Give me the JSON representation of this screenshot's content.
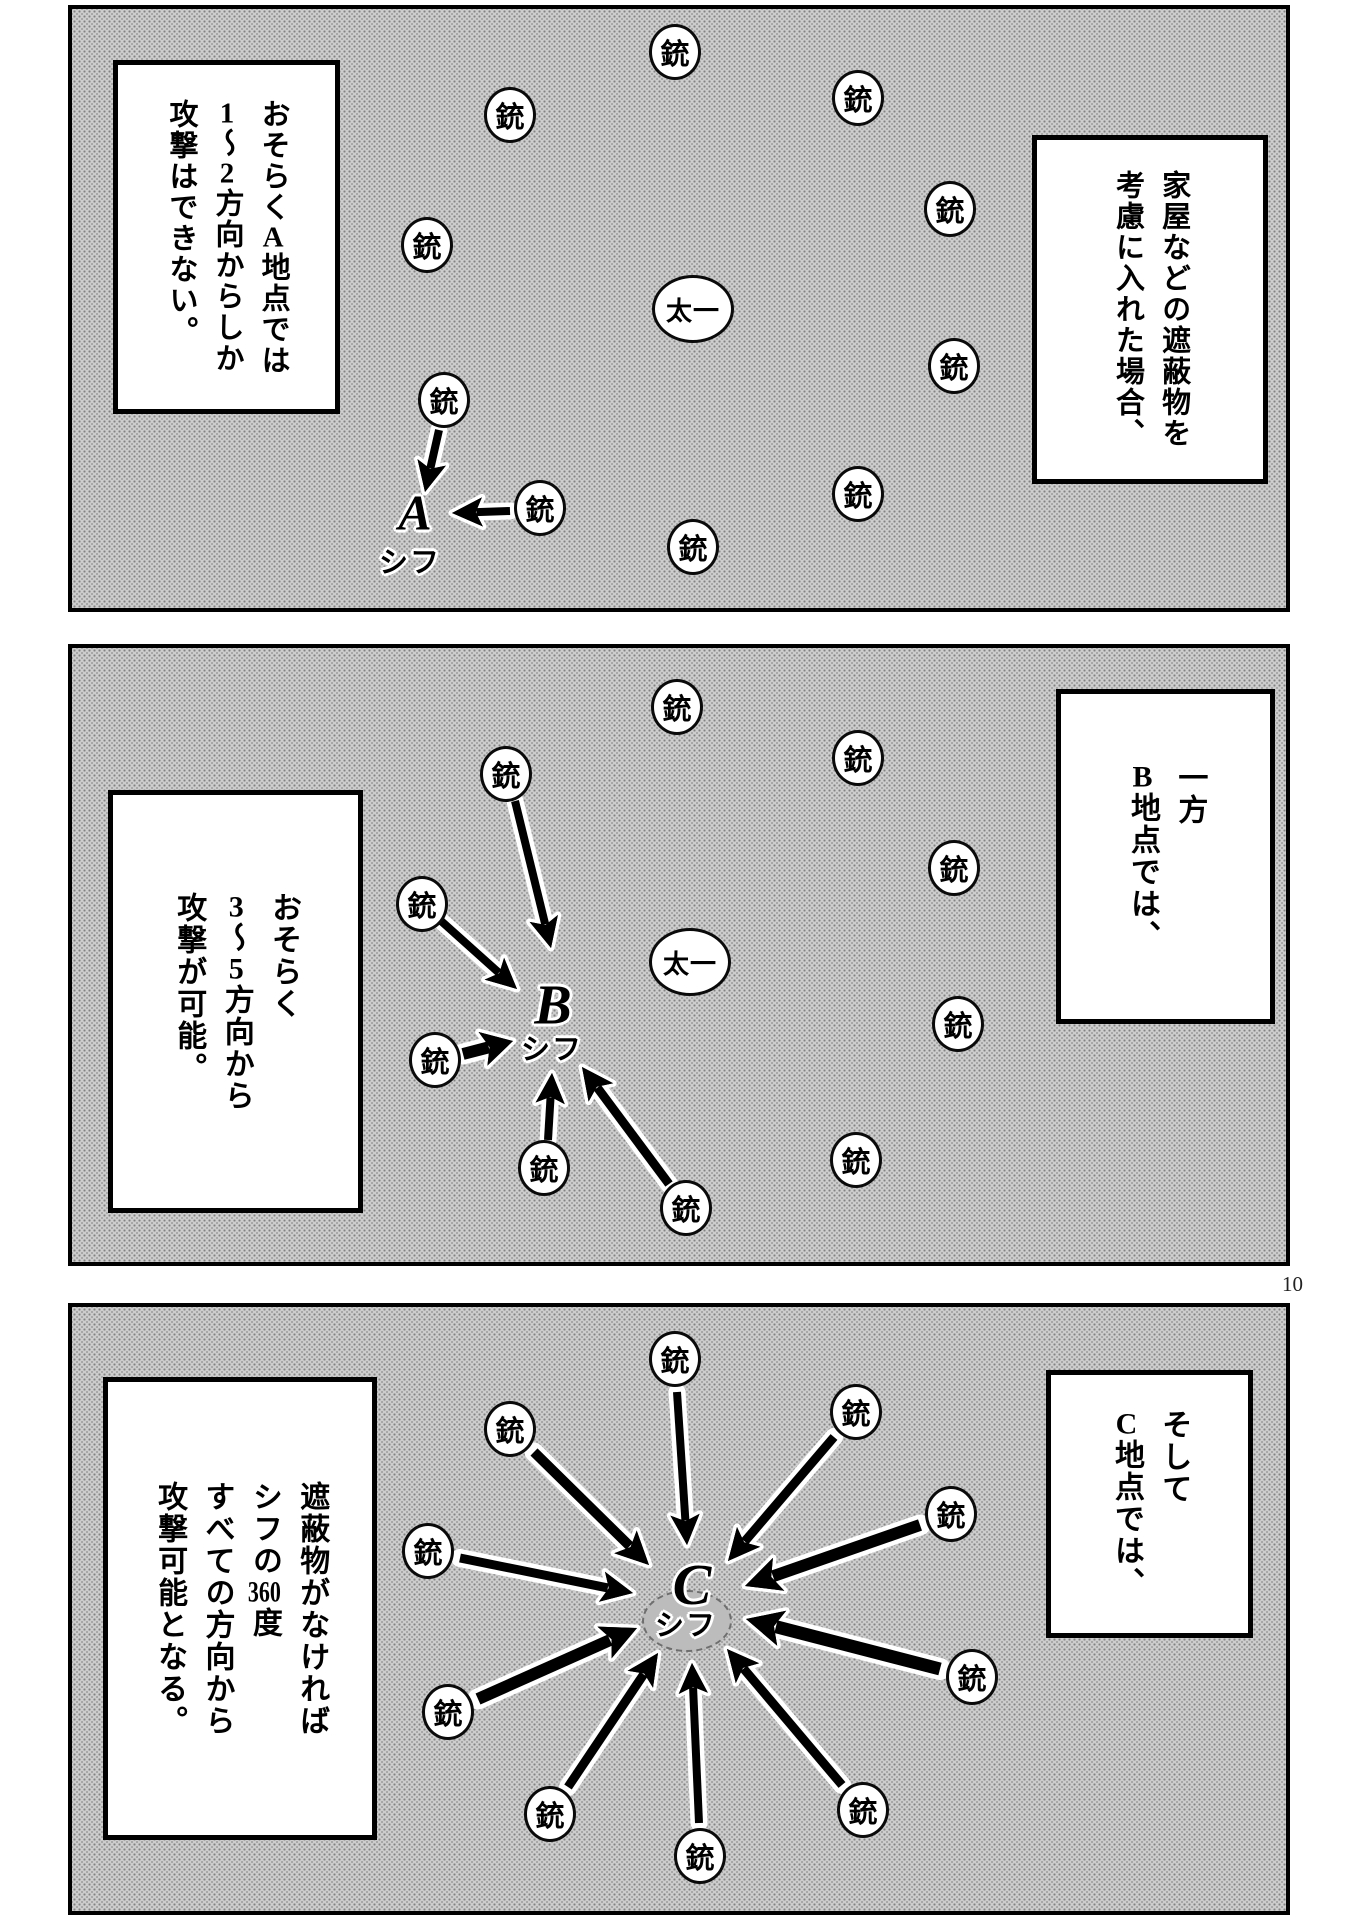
{
  "page": {
    "width": 1359,
    "height": 1920,
    "number": "10",
    "background": "#ffffff"
  },
  "colors": {
    "panel_tone": "#cdcdcd",
    "ink": "#000000",
    "circle_fill": "#ffffff",
    "spot_fill": "#bcbcbc"
  },
  "glyphs": {
    "gun": "銃",
    "taichi": "太一",
    "shifu": "シフ"
  },
  "panels": [
    {
      "id": "a",
      "frame": {
        "x": 68,
        "y": 5,
        "w": 1222,
        "h": 607
      },
      "caption_right": {
        "x": 1032,
        "y": 135,
        "w": 236,
        "h": 349,
        "font": 29,
        "columns": [
          "家屋などの遮蔽物を",
          "考慮に入れた場合、"
        ]
      },
      "caption_left": {
        "x": 113,
        "y": 60,
        "w": 227,
        "h": 354,
        "font": 29,
        "columns": [
          "おそらく[A]地点では",
          "[1]〜[2]方向からしか",
          "攻撃はできない。"
        ]
      },
      "guns": [
        [
          675,
          52
        ],
        [
          510,
          115
        ],
        [
          858,
          98
        ],
        [
          950,
          209
        ],
        [
          427,
          245
        ],
        [
          954,
          366
        ],
        [
          444,
          400
        ],
        [
          858,
          494
        ],
        [
          540,
          508
        ],
        [
          693,
          547
        ]
      ],
      "taichi": [
        693,
        309
      ],
      "point": {
        "letter": "A",
        "x": 415,
        "y": 515,
        "size": 50,
        "sub_x": 410,
        "sub_y": 560
      },
      "arrows": [
        [
          439,
          430,
          425,
          492,
          8
        ],
        [
          510,
          511,
          452,
          513,
          8
        ]
      ]
    },
    {
      "id": "b",
      "frame": {
        "x": 68,
        "y": 644,
        "w": 1222,
        "h": 622
      },
      "caption_right": {
        "x": 1056,
        "y": 689,
        "w": 219,
        "h": 335,
        "font": 30,
        "columns": [
          "一方",
          "[B]地点では、"
        ]
      },
      "caption_left": {
        "x": 108,
        "y": 790,
        "w": 255,
        "h": 423,
        "font": 30,
        "columns": [
          "おそらく",
          "[3]〜[5]方向から",
          "攻撃が可能。"
        ]
      },
      "guns": [
        [
          677,
          707
        ],
        [
          858,
          758
        ],
        [
          506,
          774
        ],
        [
          954,
          868
        ],
        [
          422,
          904
        ],
        [
          958,
          1024
        ],
        [
          435,
          1060
        ],
        [
          856,
          1160
        ],
        [
          544,
          1168
        ],
        [
          686,
          1208
        ]
      ],
      "taichi": [
        690,
        962
      ],
      "point": {
        "letter": "B",
        "x": 553,
        "y": 1008,
        "size": 56,
        "sub_x": 552,
        "sub_y": 1047
      },
      "arrows": [
        [
          515,
          801,
          551,
          948,
          8
        ],
        [
          440,
          920,
          517,
          989,
          8
        ],
        [
          463,
          1054,
          513,
          1041,
          12
        ],
        [
          548,
          1140,
          552,
          1073,
          8
        ],
        [
          669,
          1184,
          582,
          1067,
          9
        ]
      ]
    },
    {
      "id": "c",
      "frame": {
        "x": 68,
        "y": 1303,
        "w": 1222,
        "h": 612
      },
      "caption_right": {
        "x": 1046,
        "y": 1370,
        "w": 207,
        "h": 268,
        "font": 30,
        "columns": [
          "そして",
          "[C]地点では、"
        ]
      },
      "caption_left": {
        "x": 103,
        "y": 1377,
        "w": 274,
        "h": 463,
        "font": 30,
        "columns": [
          "遮蔽物がなければ",
          "シフの[360]度",
          "すべての方向から",
          "攻撃可能となる。"
        ]
      },
      "guns": [
        [
          675,
          1359
        ],
        [
          510,
          1429
        ],
        [
          856,
          1412
        ],
        [
          951,
          1514
        ],
        [
          428,
          1551
        ],
        [
          448,
          1712
        ],
        [
          972,
          1677
        ],
        [
          550,
          1814
        ],
        [
          700,
          1856
        ],
        [
          863,
          1810
        ]
      ],
      "taichi": null,
      "spot": {
        "x": 687,
        "y": 1621,
        "rx": 45,
        "ry": 31
      },
      "point": {
        "letter": "C",
        "x": 692,
        "y": 1587,
        "size": 58,
        "sub_x": 686,
        "sub_y": 1623
      },
      "arrows": [
        [
          677,
          1392,
          687,
          1545,
          8
        ],
        [
          534,
          1452,
          649,
          1565,
          10
        ],
        [
          834,
          1437,
          728,
          1561,
          9
        ],
        [
          920,
          1525,
          745,
          1586,
          12
        ],
        [
          460,
          1558,
          633,
          1593,
          9
        ],
        [
          478,
          1699,
          637,
          1628,
          12
        ],
        [
          940,
          1669,
          746,
          1619,
          13
        ],
        [
          568,
          1787,
          658,
          1653,
          9
        ],
        [
          699,
          1823,
          692,
          1663,
          8
        ],
        [
          842,
          1785,
          727,
          1649,
          9
        ]
      ]
    }
  ]
}
